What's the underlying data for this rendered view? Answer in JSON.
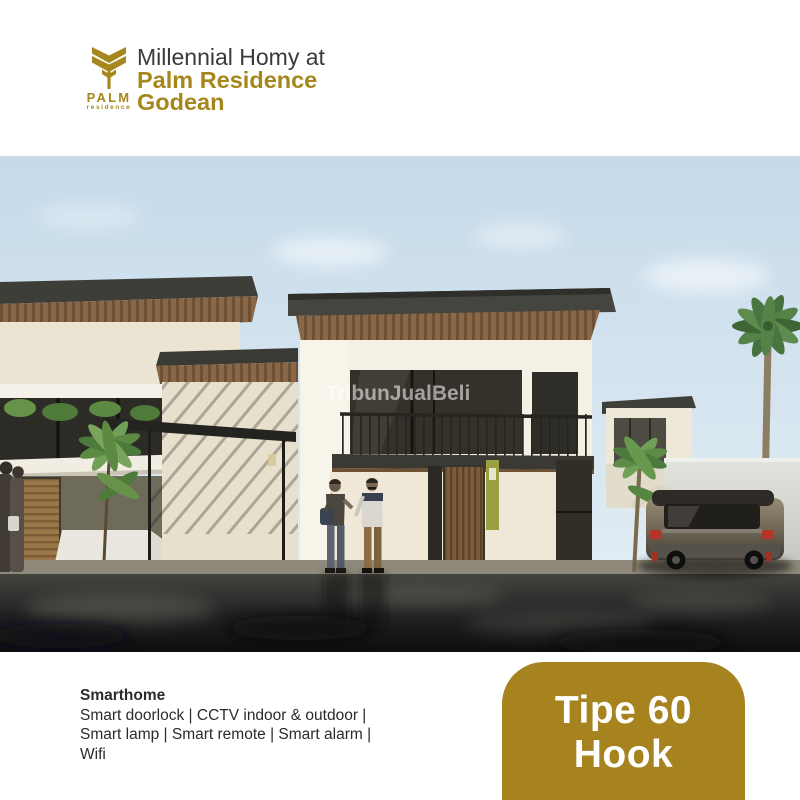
{
  "header": {
    "logo": {
      "brand": "PALM",
      "sub": "residence",
      "icon": "palm-tree-icon"
    },
    "line1": "Millennial Homy at",
    "line2": "Palm Residence",
    "line3": "Godean"
  },
  "photo": {
    "watermark": "TribunJualBeli",
    "subject": "two-story modern house exterior render with carport, palm trees, minivan and two people talking"
  },
  "footer": {
    "title": "Smarthome",
    "lines": [
      "Smart doorlock | CCTV indoor &  outdoor |",
      "Smart lamp | Smart remote | Smart alarm |",
      "Wifi"
    ],
    "badge": {
      "line1": "Tipe 60",
      "line2": "Hook"
    }
  },
  "colors": {
    "brand_gold": "#A6871E",
    "badge_gold": "#A6831F",
    "title_dark": "#3A3A3A",
    "sky_blue": "#C6DAEA"
  }
}
